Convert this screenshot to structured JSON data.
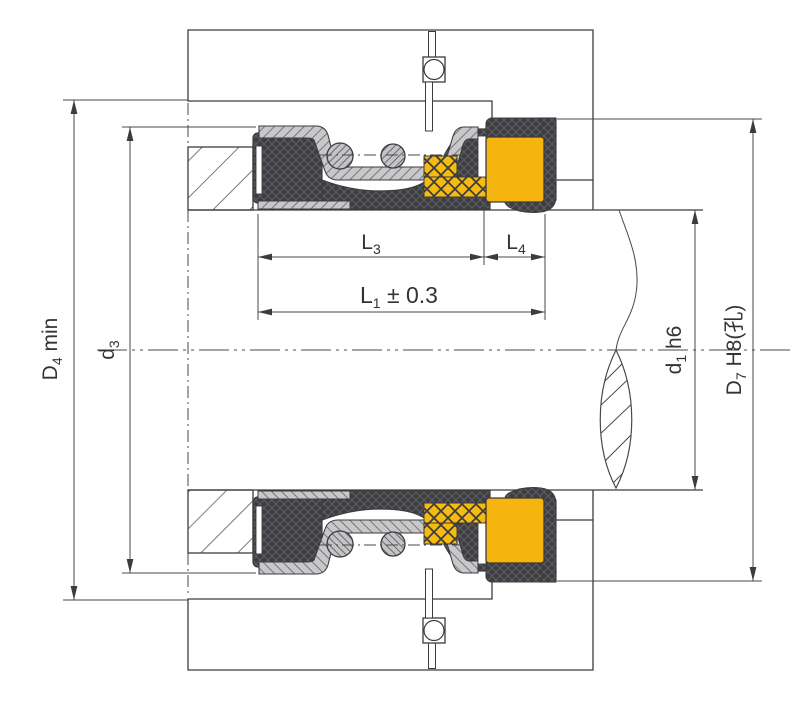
{
  "labels": {
    "d4": {
      "base": "D",
      "sub": "4",
      "suffix": " min"
    },
    "d3": {
      "base": "d",
      "sub": "3"
    },
    "l3": {
      "base": "L",
      "sub": "3"
    },
    "l4": {
      "base": "L",
      "sub": "4"
    },
    "l1": {
      "base": "L",
      "sub": "1",
      "suffix": " ± 0.3"
    },
    "d1": {
      "base": "d",
      "sub": "1",
      "suffix": " h6"
    },
    "d7": {
      "base": "D",
      "sub": "7",
      "suffix": " H8(孔)"
    }
  },
  "colors": {
    "seat_yellow": "#f5b40e",
    "ring_yellow_hatch": "#f7bb10",
    "rubber_dark": "#3e3e41",
    "metal_gray": "#c8c8ca",
    "outline": "#3c3c3e",
    "hatch_gray": "#7a7a7a",
    "background": "#ffffff"
  }
}
